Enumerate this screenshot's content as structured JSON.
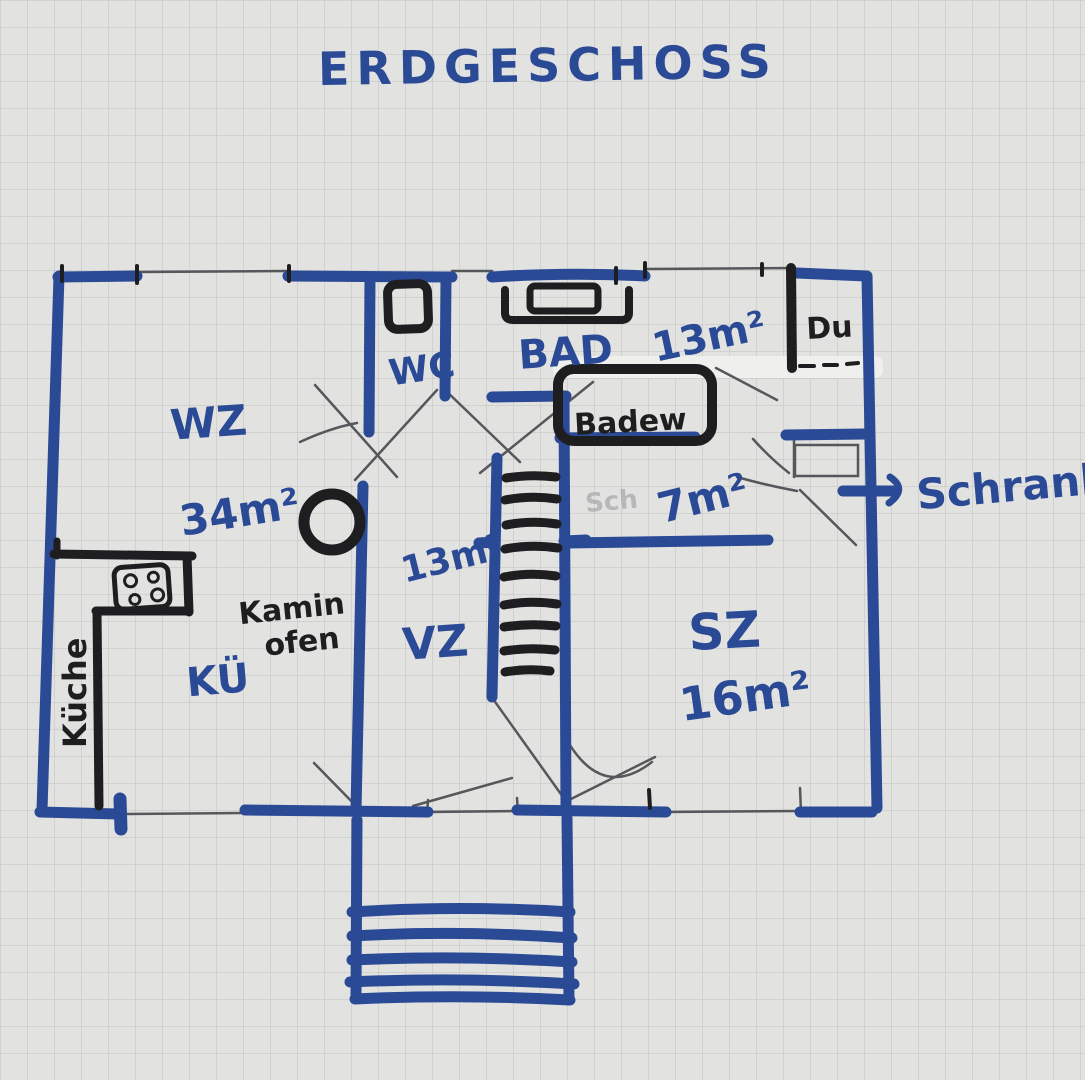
{
  "title": "ERDGESCHOSS",
  "labels": {
    "living_room": "WZ",
    "living_room_area": "34m²",
    "kitchen_short": "KÜ",
    "kitchen_counter": "Küche",
    "wood_stove_line1": "Kamin",
    "wood_stove_line2": "ofen",
    "wc": "WC",
    "bath": "BAD",
    "bath_area": "13m²",
    "bathtub": "Badew",
    "shower": "Du",
    "corridor_area": "7m²",
    "bedroom": "SZ",
    "bedroom_area": "16m²",
    "hall": "VZ",
    "hall_area": "13m²",
    "closet": "Schrank",
    "faint_pencil_note": "Sch"
  },
  "colors": {
    "marker_blue": "#2b4a96",
    "marker_black": "#1e1e20",
    "pencil_gray": "#55575b",
    "paper": "#e2e2e0",
    "grid_line": "#a3a6a8"
  }
}
